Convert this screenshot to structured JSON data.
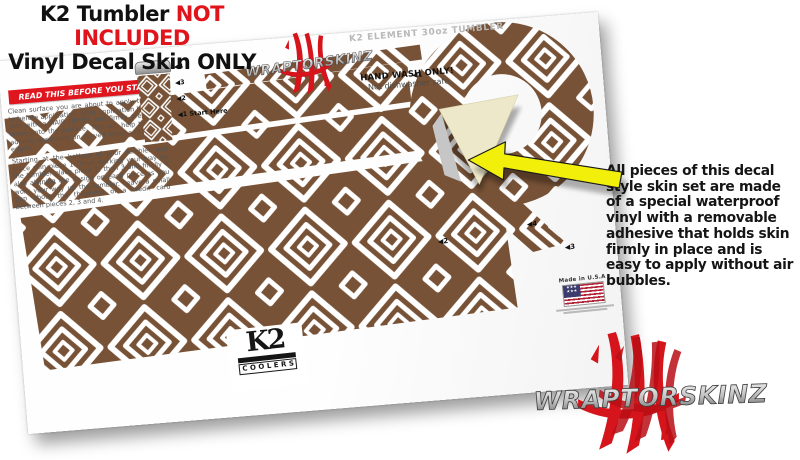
{
  "header": {
    "title_prefix": "K2 Tumbler ",
    "title_highlight": "NOT INCLUDED",
    "subtitle": "Vinyl Decal Skin ONLY"
  },
  "sheet": {
    "product_label": "K2 ELEMENT 30oz TUMBLER",
    "brand": "WRAPTORSKINZ",
    "warning_banner": "READ THIS BEFORE YOU START",
    "instructions_1": "Clean surface you are about to apply the skin to before application. After application heat the skin with a HAIR DRYER and firmly press skin down onto the surface. This will help the skin adhere, especially on curved areas and around edges.",
    "instructions_2": "Starting at the bottom of your tumbler and place skin piece 1. Then working your way up the tumbler place piece 2, then 3 and finally 4 also aligning the design on each piece as you work your way up the tumbler. Leave a small gap about the thickness of a credit card between pieces 2, 3 and 4.",
    "hand_wash_title": "HAND WASH ONLY!",
    "hand_wash_sub": "Not dishwasher safe.",
    "guide": {
      "g4": "◀4",
      "g3": "◀3",
      "g2": "◀2",
      "g1": "◀1 Start Here"
    },
    "markers": {
      "m1": "◀1",
      "m2": "◀2",
      "m3": "◀3",
      "m4": "◀4"
    },
    "made_in": "Made in U.S.A",
    "k2_logo": {
      "name": "K2",
      "sub": "COOLERS"
    }
  },
  "annotation": {
    "note": "All pieces of this decal style skin set are made of a special waterproof vinyl with a removable adhesive that holds skin firmly in place and is easy to apply without air bubbles."
  },
  "footer_brand": "WRAPTORSKINZ",
  "colors": {
    "pattern_brown": "#775236",
    "accent_red": "#e0161f",
    "arrow_yellow": "#f2ef0a",
    "backing_cream": "#ede8ca",
    "brand_claw_red": "#d6141c"
  }
}
